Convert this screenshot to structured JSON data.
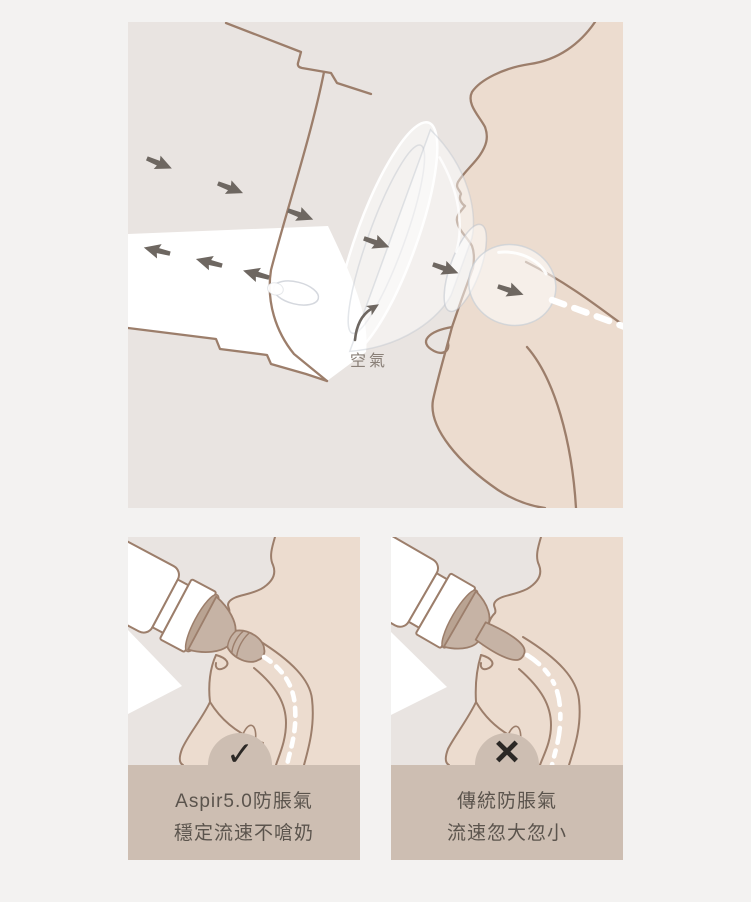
{
  "page": {
    "background": "#f3f2f1",
    "description_colors": {
      "panel_bg": "#e9e4e1",
      "skin": "#ecdccf",
      "outline_brown": "#9c7e6b",
      "arrow_gray": "#6e6761",
      "caption_band": "#cdbeb2",
      "caption_text": "#5b544d",
      "verdict_mark": "#2b2825",
      "nipple_tan": "#c6b3a5",
      "milk_white": "#ffffff",
      "air_label_gray": "#8a8078"
    }
  },
  "top_panel": {
    "air_label": "空氣",
    "icons": [
      "air-flow-arrow",
      "air-return-arrow",
      "air-intake-curved-arrow",
      "milk-flow-dashed-line"
    ]
  },
  "comparison": {
    "left": {
      "verdict": "pass",
      "verdict_icon": "✓",
      "line1": "Aspir5.0防脹氣",
      "line2": "穩定流速不嗆奶"
    },
    "right": {
      "verdict": "fail",
      "verdict_icon": "×",
      "line1": "傳統防脹氣",
      "line2": "流速忽大忽小"
    }
  }
}
